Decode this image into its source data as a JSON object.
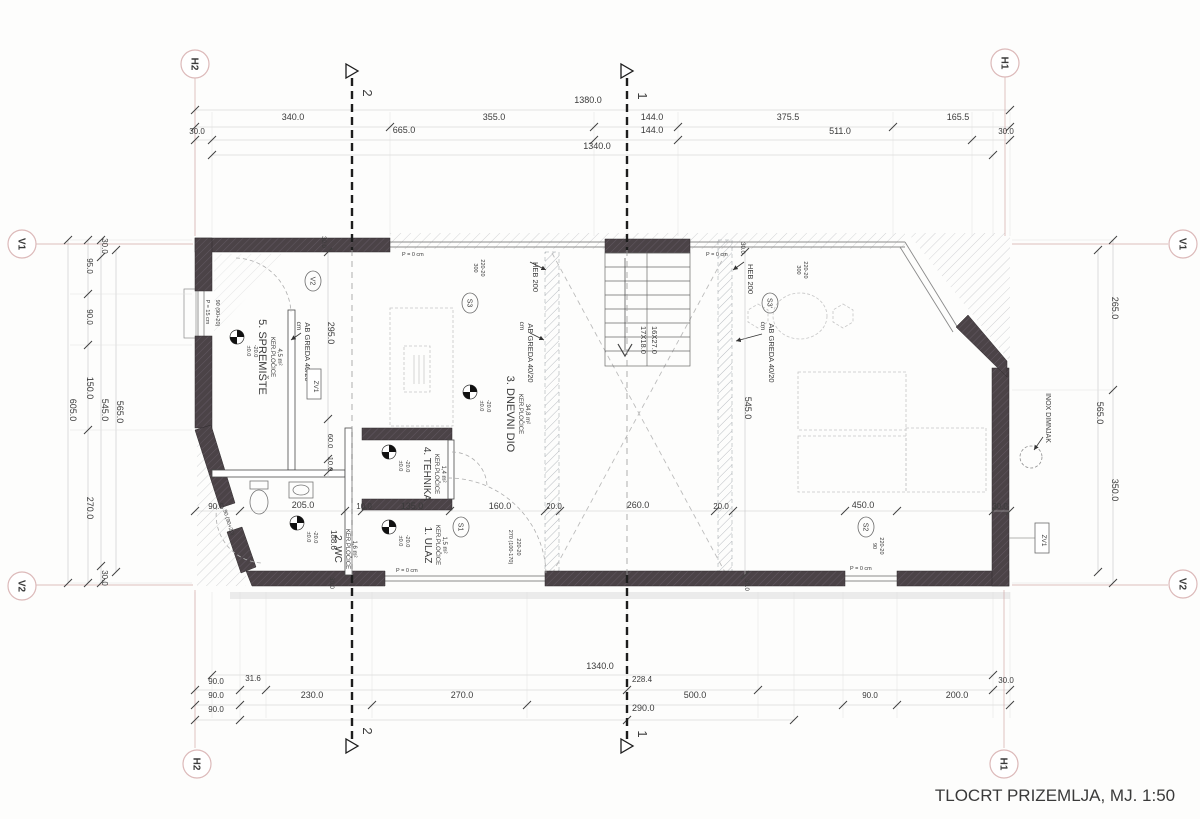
{
  "title": {
    "text": "TLOCRT PRIZEMLJA, MJ. 1:50"
  },
  "axis_markers": [
    {
      "t": "H2",
      "x": 195,
      "y": 64
    },
    {
      "t": "H1",
      "x": 1005,
      "y": 63
    },
    {
      "t": "V1",
      "x": 22,
      "y": 244
    },
    {
      "t": "V2",
      "x": 22,
      "y": 586
    },
    {
      "t": "V1",
      "x": 1183,
      "y": 244
    },
    {
      "t": "V2",
      "x": 1183,
      "y": 584
    },
    {
      "t": "H2",
      "x": 197,
      "y": 764
    },
    {
      "t": "H1",
      "x": 1004,
      "y": 764
    }
  ],
  "section_markers": [
    {
      "t": "2",
      "x": 352,
      "ty": 93,
      "by": 731
    },
    {
      "t": "1",
      "x": 627,
      "ty": 96,
      "by": 734
    }
  ],
  "bubbles": [
    {
      "t": "V2",
      "x": 313,
      "y": 281
    },
    {
      "t": "S3",
      "x": 470,
      "y": 303
    },
    {
      "t": "S3'",
      "x": 770,
      "y": 303
    },
    {
      "t": "S1",
      "x": 461,
      "y": 527
    },
    {
      "t": "S2",
      "x": 866,
      "y": 527
    }
  ],
  "zv_boxes": [
    {
      "t": "ZV1",
      "x": 314,
      "y": 384
    },
    {
      "t": "ZV1",
      "x": 1042,
      "y": 538
    }
  ],
  "level_markers": [
    {
      "x": 237,
      "y": 337,
      "l1": "±0.0",
      "l2": "-20.0"
    },
    {
      "x": 470,
      "y": 392,
      "l1": "±0.0",
      "l2": "-20.0"
    },
    {
      "x": 389,
      "y": 452,
      "l1": "±0.0",
      "l2": "-20.0"
    },
    {
      "x": 389,
      "y": 527,
      "l1": "±0.0",
      "l2": "-20.0"
    },
    {
      "x": 297,
      "y": 523,
      "l1": "±0.0",
      "l2": "-20.0"
    }
  ],
  "labels": [
    {
      "t": "1380.0",
      "x": 588,
      "y": 103
    },
    {
      "t": "340.0",
      "x": 293,
      "y": 120
    },
    {
      "t": "355.0",
      "x": 494,
      "y": 120
    },
    {
      "t": "144.0",
      "x": 652,
      "y": 120
    },
    {
      "t": "375.5",
      "x": 788,
      "y": 120
    },
    {
      "t": "165.5",
      "x": 958,
      "y": 120
    },
    {
      "t": "30.0",
      "x": 197,
      "y": 134,
      "s": 8
    },
    {
      "t": "665.0",
      "x": 404,
      "y": 133
    },
    {
      "t": "144.0",
      "x": 652,
      "y": 133
    },
    {
      "t": "511.0",
      "x": 840,
      "y": 134
    },
    {
      "t": "30.0",
      "x": 1006,
      "y": 134,
      "s": 8
    },
    {
      "t": "1340.0",
      "x": 597,
      "y": 149
    },
    {
      "t": "1340.0",
      "x": 600,
      "y": 669
    },
    {
      "t": "90.0",
      "x": 216,
      "y": 684,
      "s": 8
    },
    {
      "t": "31.6",
      "x": 253,
      "y": 681,
      "s": 8
    },
    {
      "t": "228.4",
      "x": 632,
      "y": 682,
      "s": 8,
      "a": "s"
    },
    {
      "t": "30.0",
      "x": 1006,
      "y": 683,
      "s": 8
    },
    {
      "t": "90.0",
      "x": 216,
      "y": 698,
      "s": 8
    },
    {
      "t": "230.0",
      "x": 312,
      "y": 698
    },
    {
      "t": "270.0",
      "x": 462,
      "y": 698
    },
    {
      "t": "500.0",
      "x": 695,
      "y": 698
    },
    {
      "t": "90.0",
      "x": 870,
      "y": 698,
      "s": 8
    },
    {
      "t": "200.0",
      "x": 957,
      "y": 698
    },
    {
      "t": "90.0",
      "x": 216,
      "y": 712,
      "s": 8
    },
    {
      "t": "290.0",
      "x": 632,
      "y": 711,
      "a": "s"
    },
    {
      "t": "605.0",
      "x": 70,
      "y": 410,
      "r": 90
    },
    {
      "t": "95.0",
      "x": 87,
      "y": 266,
      "r": 90,
      "s": 8
    },
    {
      "t": "90.0",
      "x": 87,
      "y": 317,
      "r": 90,
      "s": 8
    },
    {
      "t": "150.0",
      "x": 87,
      "y": 388,
      "r": 90
    },
    {
      "t": "270.0",
      "x": 87,
      "y": 508,
      "r": 90
    },
    {
      "t": "30.0",
      "x": 102,
      "y": 246,
      "r": 90,
      "s": 8
    },
    {
      "t": "545.0",
      "x": 102,
      "y": 410,
      "r": 90
    },
    {
      "t": "30.0",
      "x": 102,
      "y": 578,
      "r": 90,
      "s": 8
    },
    {
      "t": "565.0",
      "x": 117,
      "y": 412,
      "r": 90
    },
    {
      "t": "265.0",
      "x": 1112,
      "y": 308,
      "r": 90
    },
    {
      "t": "565.0",
      "x": 1097,
      "y": 413,
      "r": 90
    },
    {
      "t": "350.0",
      "x": 1112,
      "y": 490,
      "r": 90
    },
    {
      "t": "INOX DIMNJAK",
      "x": 1046,
      "y": 418,
      "r": 90,
      "s": 7
    },
    {
      "t": "90.0",
      "x": 216,
      "y": 509,
      "s": 8
    },
    {
      "t": "205.0",
      "x": 303,
      "y": 508
    },
    {
      "t": "10.0",
      "x": 364,
      "y": 509,
      "s": 8
    },
    {
      "t": "135.0",
      "x": 412,
      "y": 509
    },
    {
      "t": "160.0",
      "x": 500,
      "y": 509
    },
    {
      "t": "20.0",
      "x": 554,
      "y": 509,
      "s": 8
    },
    {
      "t": "260.0",
      "x": 638,
      "y": 508
    },
    {
      "t": "20.0",
      "x": 721,
      "y": 509,
      "s": 8
    },
    {
      "t": "450.0",
      "x": 863,
      "y": 508
    },
    {
      "t": "30.0",
      "x": 1000,
      "y": 509,
      "s": 8
    },
    {
      "t": "295.0",
      "x": 328,
      "y": 333,
      "r": 90
    },
    {
      "t": "60.0",
      "x": 328,
      "y": 441,
      "r": 90,
      "s": 7.5
    },
    {
      "t": "10.0",
      "x": 328,
      "y": 464,
      "r": 90,
      "s": 7.5
    },
    {
      "t": "188.6",
      "x": 331,
      "y": 540,
      "r": 90,
      "s": 8
    },
    {
      "t": "545.0",
      "x": 745,
      "y": 408,
      "r": 90
    },
    {
      "t": "30.0",
      "x": 322,
      "y": 242,
      "r": 90,
      "s": 6
    },
    {
      "t": "30.0",
      "x": 741,
      "y": 248,
      "r": 90,
      "s": 6
    },
    {
      "t": "30.0",
      "x": 330,
      "y": 583,
      "r": 90,
      "s": 6
    },
    {
      "t": "30.0",
      "x": 745,
      "y": 585,
      "r": 90,
      "s": 6
    },
    {
      "t": "5. SPREMIŠTE",
      "x": 259,
      "y": 357,
      "r": 90,
      "s": 11
    },
    {
      "t": "KER.PLOČICE",
      "x": 271,
      "y": 357,
      "r": 90,
      "s": 6
    },
    {
      "t": "4,5 m²",
      "x": 278,
      "y": 357,
      "r": 90,
      "s": 6
    },
    {
      "t": "3. DNEVNI DIO",
      "x": 507,
      "y": 414,
      "r": 90,
      "s": 11
    },
    {
      "t": "KER.PLOČICE",
      "x": 519,
      "y": 414,
      "r": 90,
      "s": 6
    },
    {
      "t": "34,8 m²",
      "x": 526,
      "y": 414,
      "r": 90,
      "s": 6
    },
    {
      "t": "4. TEHNIKA",
      "x": 424,
      "y": 474,
      "r": 90,
      "s": 10
    },
    {
      "t": "KER.PLOČICE",
      "x": 435,
      "y": 474,
      "r": 90,
      "s": 6
    },
    {
      "t": "1,4 m²",
      "x": 442,
      "y": 474,
      "r": 90,
      "s": 6
    },
    {
      "t": "2. WC",
      "x": 335,
      "y": 549,
      "r": 90,
      "s": 10
    },
    {
      "t": "KER.PLOČICE",
      "x": 346,
      "y": 549,
      "r": 90,
      "s": 6
    },
    {
      "t": "1,6 m²",
      "x": 353,
      "y": 549,
      "r": 90,
      "s": 6
    },
    {
      "t": "1. ULAZ",
      "x": 425,
      "y": 545,
      "r": 90,
      "s": 10
    },
    {
      "t": "KER.PLOČICE",
      "x": 436,
      "y": 545,
      "r": 90,
      "s": 6
    },
    {
      "t": "1,5 m²",
      "x": 443,
      "y": 545,
      "r": 90,
      "s": 6
    },
    {
      "t": "HEB 200",
      "x": 533,
      "y": 277,
      "r": 90,
      "s": 7.5
    },
    {
      "t": "HEB 200",
      "x": 748,
      "y": 279,
      "r": 90,
      "s": 7.5
    },
    {
      "t": "AB GREDA 40/20",
      "x": 528,
      "y": 353,
      "r": 90,
      "s": 7.5
    },
    {
      "t": "cm",
      "x": 520,
      "y": 326,
      "r": 90,
      "s": 6.5
    },
    {
      "t": "AB GREDA 40/20",
      "x": 769,
      "y": 353,
      "r": 90,
      "s": 7.5
    },
    {
      "t": "cm",
      "x": 761,
      "y": 326,
      "r": 90,
      "s": 6.5
    },
    {
      "t": "AB GREDA 40/20",
      "x": 305,
      "y": 352,
      "r": 90,
      "s": 7.5
    },
    {
      "t": "cm",
      "x": 297,
      "y": 326,
      "r": 90,
      "s": 6.5
    },
    {
      "t": "17X18.0",
      "x": 641,
      "y": 340,
      "r": 90,
      "s": 7.5
    },
    {
      "t": "16X27.0",
      "x": 652,
      "y": 340,
      "r": 90,
      "s": 7.5
    },
    {
      "t": "300",
      "x": 474,
      "y": 268,
      "r": 90,
      "s": 5.5
    },
    {
      "t": "220-20",
      "x": 481,
      "y": 268,
      "r": 90,
      "s": 5.5
    },
    {
      "t": "300",
      "x": 797,
      "y": 270,
      "r": 90,
      "s": 5.5
    },
    {
      "t": "220-20",
      "x": 804,
      "y": 270,
      "r": 90,
      "s": 5.5
    },
    {
      "t": "270 (100-170)",
      "x": 509,
      "y": 547,
      "r": 90,
      "s": 5.5
    },
    {
      "t": "220-20",
      "x": 517,
      "y": 547,
      "r": 90,
      "s": 5.5
    },
    {
      "t": "90",
      "x": 873,
      "y": 546,
      "r": 90,
      "s": 5.5
    },
    {
      "t": "220-20",
      "x": 880,
      "y": 546,
      "r": 90,
      "s": 5.5
    },
    {
      "t": "90 (90+20)",
      "x": 227,
      "y": 523,
      "r": 73,
      "s": 5.5
    },
    {
      "t": "P = 15 cm",
      "x": 206,
      "y": 312,
      "r": 90,
      "s": 5.5
    },
    {
      "t": "90 (90+20)",
      "x": 216,
      "y": 313,
      "r": 90,
      "s": 5.5
    },
    {
      "t": "P = 0 cm",
      "x": 402,
      "y": 256,
      "s": 5.5,
      "a": "s"
    },
    {
      "t": "P = 0 cm",
      "x": 706,
      "y": 256,
      "s": 5.5,
      "a": "s"
    },
    {
      "t": "P = 0 cm",
      "x": 396,
      "y": 572,
      "s": 5.5,
      "a": "s"
    },
    {
      "t": "P = 0 cm",
      "x": 850,
      "y": 570,
      "s": 5.5,
      "a": "s"
    }
  ]
}
